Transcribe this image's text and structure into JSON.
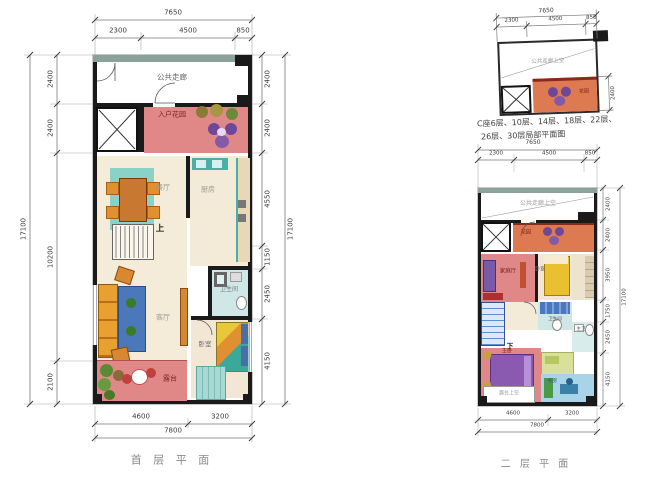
{
  "captions": {
    "floor1": "首 层 平 面",
    "floor2": "二 层 平 面"
  },
  "note": {
    "line1": "C座6层、10层、14层、18层、22层、",
    "line2": "26层、30层局部平面图"
  },
  "f1": {
    "top": {
      "total": "7650",
      "segs": [
        "2300",
        "4500",
        "850"
      ]
    },
    "bottom": {
      "total": "7800",
      "segs": [
        "4600",
        "3200"
      ]
    },
    "left": {
      "total": "17100",
      "segs": [
        "2400",
        "2400",
        "10200",
        "2100"
      ]
    },
    "right": {
      "total": "17100",
      "segs": [
        "2400",
        "2400",
        "4550",
        "1150",
        "2450",
        "4150"
      ]
    },
    "rooms": {
      "corridor": "公共走廊",
      "garden": "入户花园",
      "dining": "餐厅",
      "kitchen": "厨房",
      "living": "客厅",
      "bath": "卫生间",
      "bedroom": "卧室",
      "terrace": "露台",
      "stair": "上"
    }
  },
  "mini": {
    "top": {
      "total": "7650",
      "segs": [
        "2300",
        "4500",
        "850"
      ]
    },
    "right": {
      "seg": "2400"
    },
    "rooms": {
      "corridor": "公共走廊上空",
      "garden": "花园"
    }
  },
  "f2": {
    "top": {
      "total": "7650",
      "segs": [
        "2300",
        "4500",
        "850"
      ]
    },
    "bottom": {
      "total": "7800",
      "segs": [
        "4600",
        "3200"
      ]
    },
    "right": {
      "total": "17100",
      "segs": [
        "2400",
        "2400",
        "3950",
        "1750",
        "2450",
        "4150"
      ]
    },
    "rooms": {
      "corridor": "公共走廊上空",
      "garden": "花园",
      "family": "家庭厅",
      "bedroom": "卧室",
      "bath": "卫生间",
      "master": "主卧",
      "master_bath": "主卫",
      "study": "书房",
      "terrace": "露台上空",
      "stair": "下"
    }
  },
  "colors": {
    "wall": "#1a1a1a",
    "corridor_wall": "#8ba29a",
    "salmon": "#e08888",
    "orange_room": "#dd7a52",
    "beige": "#f5ebd9",
    "cyan_bath": "#cfe7e7",
    "teal_accent": "#49b0a8",
    "stair_blue": "#5b8ed6",
    "study_blue": "#a9d4e8"
  }
}
